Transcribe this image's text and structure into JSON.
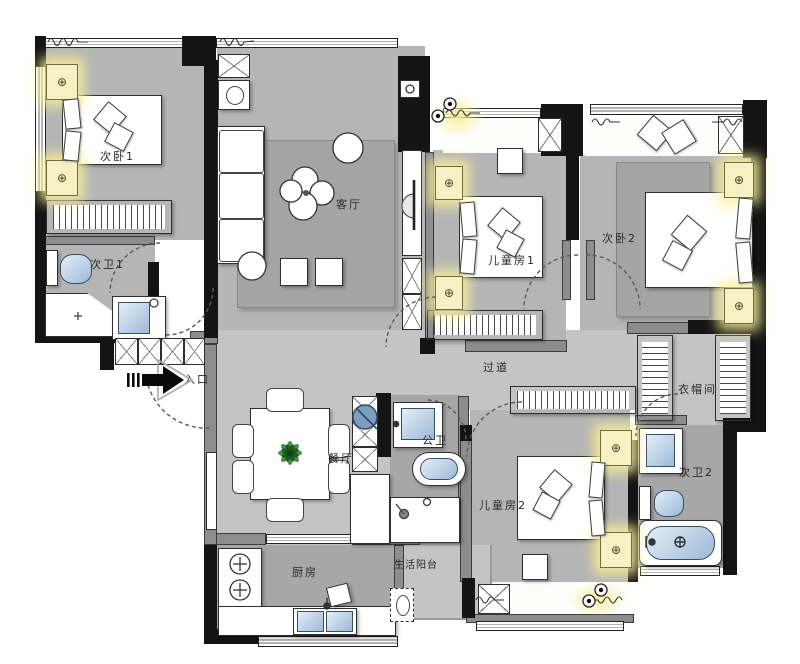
{
  "colors": {
    "wall": "#141414",
    "gwall": "#8d8d8d",
    "floor": "#b5b5b5",
    "floorlight": "#c4c4c4",
    "floordark": "#a7a7a7",
    "rug": "#a4a4a4",
    "lamp": "#f6f0c2",
    "fixture": "#9db9d6",
    "plant": "#2f7a33"
  },
  "icons": {
    "lamp": "⊕"
  },
  "rooms": {
    "bedroom1": {
      "label": "次卧1"
    },
    "living": {
      "label": "客厅"
    },
    "kids1": {
      "label": "儿童房1"
    },
    "bedroom2": {
      "label": "次卧2"
    },
    "bath1": {
      "label": "次卫1"
    },
    "entrance": {
      "label": "入口"
    },
    "corridor": {
      "label": "过道"
    },
    "closet": {
      "label": "衣帽间"
    },
    "dining": {
      "label": "餐厅"
    },
    "bath_public": {
      "label": "公卫"
    },
    "bath2": {
      "label": "次卫2"
    },
    "kids2": {
      "label": "儿童房2"
    },
    "kitchen": {
      "label": "厨房"
    },
    "utility_balcony": {
      "label": "生活阳台"
    }
  }
}
